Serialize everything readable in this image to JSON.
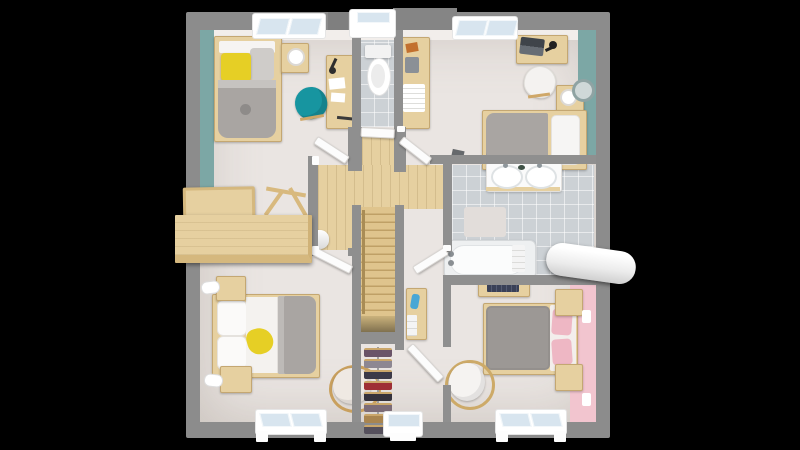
{
  "scene": {
    "kind": "floor-plan-top-down-3d-render",
    "floor_shown": "upper-floor",
    "visible_text": "none"
  },
  "palette": {
    "background": "#000000",
    "exterior_wall": "#8c8c8c",
    "interior_wall": "#8f8f8f",
    "floor": "#eae5e2",
    "wood": "#e6d0a0",
    "wood_dark": "#d5b87e",
    "stair_wood": "#dfc48d",
    "tile": "#ccd1d5",
    "teal_wall": "#7ca7a5",
    "pink_wall": "#f2c5cf",
    "teal_chair": "#1795a0",
    "yellow": "#e6cf25",
    "duvet_gray": "#a9a5a2",
    "duvet_dark": "#9c9895",
    "pink_pillow": "#eeb7c4",
    "fixture_white": "#fafafa",
    "window_glass": "#d8e5ef"
  },
  "rooms": [
    {
      "name": "bedroom-top-left",
      "accent_wall": "teal-left",
      "furniture": [
        "single-bed-yellow-pillow",
        "nightstand-lamp",
        "wall-desk-papers",
        "teal-desk-chair",
        "tray-desk",
        "trestle",
        "sideboard",
        "white-pot"
      ]
    },
    {
      "name": "wc",
      "accent_wall": null,
      "furniture": [
        "toilet"
      ]
    },
    {
      "name": "bedroom-top-right",
      "accent_wall": "teal-right",
      "furniture": [
        "shelving-unit-towels",
        "desk-laptop-lamp",
        "white-chair",
        "nightstand-lamp-mirror",
        "double-bed-gray-duvet"
      ]
    },
    {
      "name": "bathroom",
      "accent_wall": null,
      "furniture": [
        "double-sink-vanity",
        "bath-mat",
        "bathtub",
        "towel-roll-through-wall",
        "scale"
      ]
    },
    {
      "name": "landing-stairs",
      "accent_wall": null,
      "furniture": [
        "staircase-down",
        "handrail",
        "drawer-cabinet-blue-vase"
      ]
    },
    {
      "name": "bedroom-bottom-left",
      "accent_wall": null,
      "furniture": [
        "double-bed-white-gray",
        "yellow-cloth",
        "nightstand-lamp",
        "nightstand-lamp",
        "round-cream-armchair"
      ]
    },
    {
      "name": "dressing-closet",
      "accent_wall": null,
      "furniture": [
        "clothes-rack",
        "hanging-clothes"
      ]
    },
    {
      "name": "bedroom-bottom-right",
      "accent_wall": "pink-right",
      "furniture": [
        "wall-shelf-books",
        "double-bed-pink-pillows",
        "nightstand",
        "nightstand",
        "white-armchair",
        "wall-sockets"
      ]
    }
  ],
  "dressing": {
    "clothes_colors": [
      "#6a5468",
      "#8d8792",
      "#3c3a48",
      "#9e2f35",
      "#35323c",
      "#7c6c77",
      "#a9854f",
      "#55505c"
    ]
  },
  "stairs": {
    "steps": 14,
    "direction": "down-to-lower-floor"
  },
  "counts": {
    "windows_top": 3,
    "windows_bottom": 3,
    "interior_doors": 6,
    "beds": 4,
    "chairs": 5
  }
}
